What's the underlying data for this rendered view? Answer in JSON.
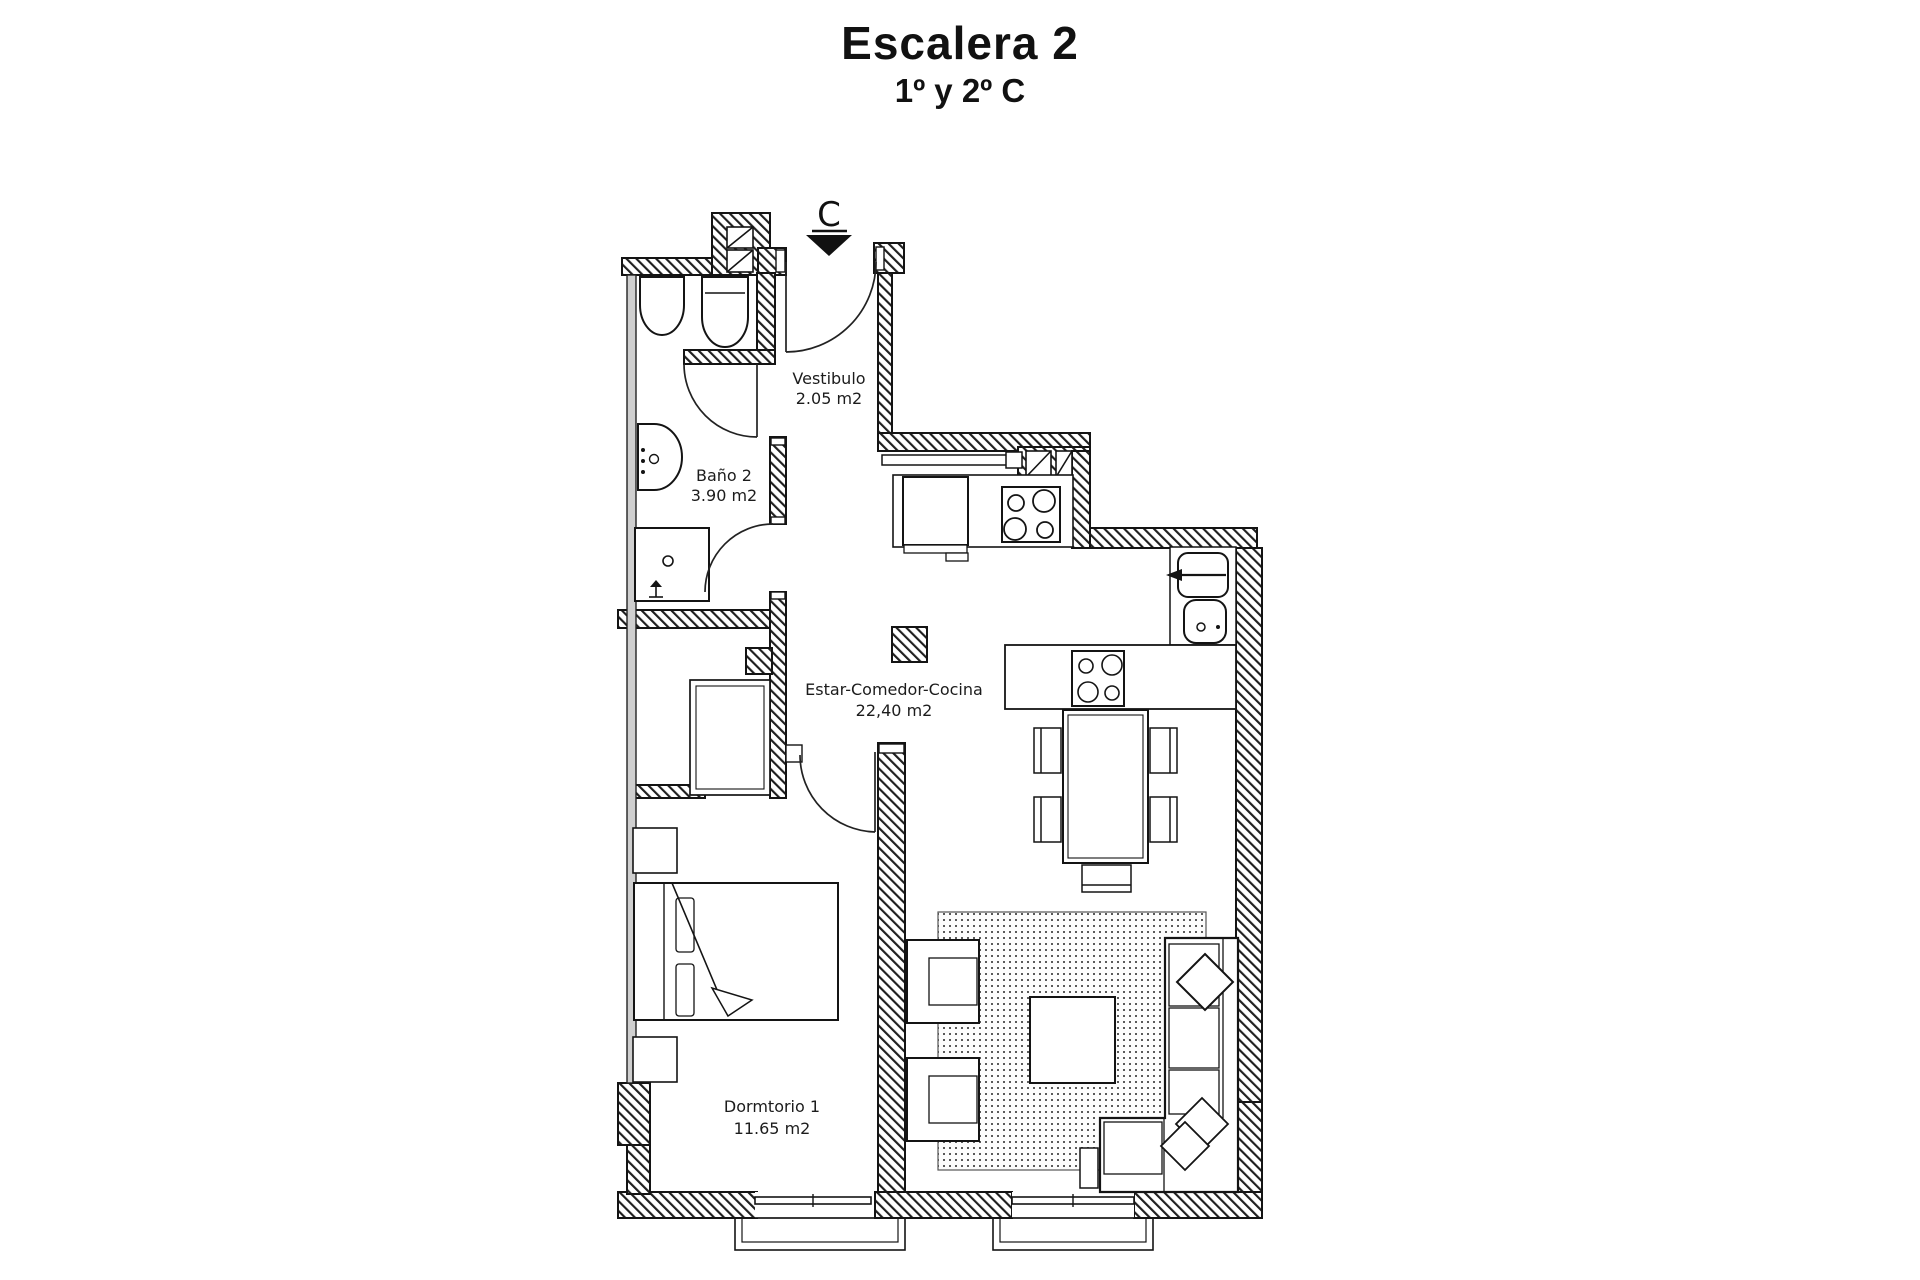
{
  "header": {
    "title": "Escalera 2",
    "subtitle": "1º y 2º C"
  },
  "plan": {
    "entrance_marker": "C",
    "rooms": [
      {
        "id": "vestibulo",
        "name": "Vestibulo",
        "area": "2.05 m2"
      },
      {
        "id": "bano2",
        "name": "Baño 2",
        "area": "3.90 m2"
      },
      {
        "id": "estar",
        "name": "Estar-Comedor-Cocina",
        "area": "22,40 m2"
      },
      {
        "id": "dormitorio1",
        "name": "Dormtorio 1",
        "area": "11.65 m2"
      }
    ],
    "colors": {
      "wall_line": "#141414",
      "paper": "#ffffff"
    }
  }
}
